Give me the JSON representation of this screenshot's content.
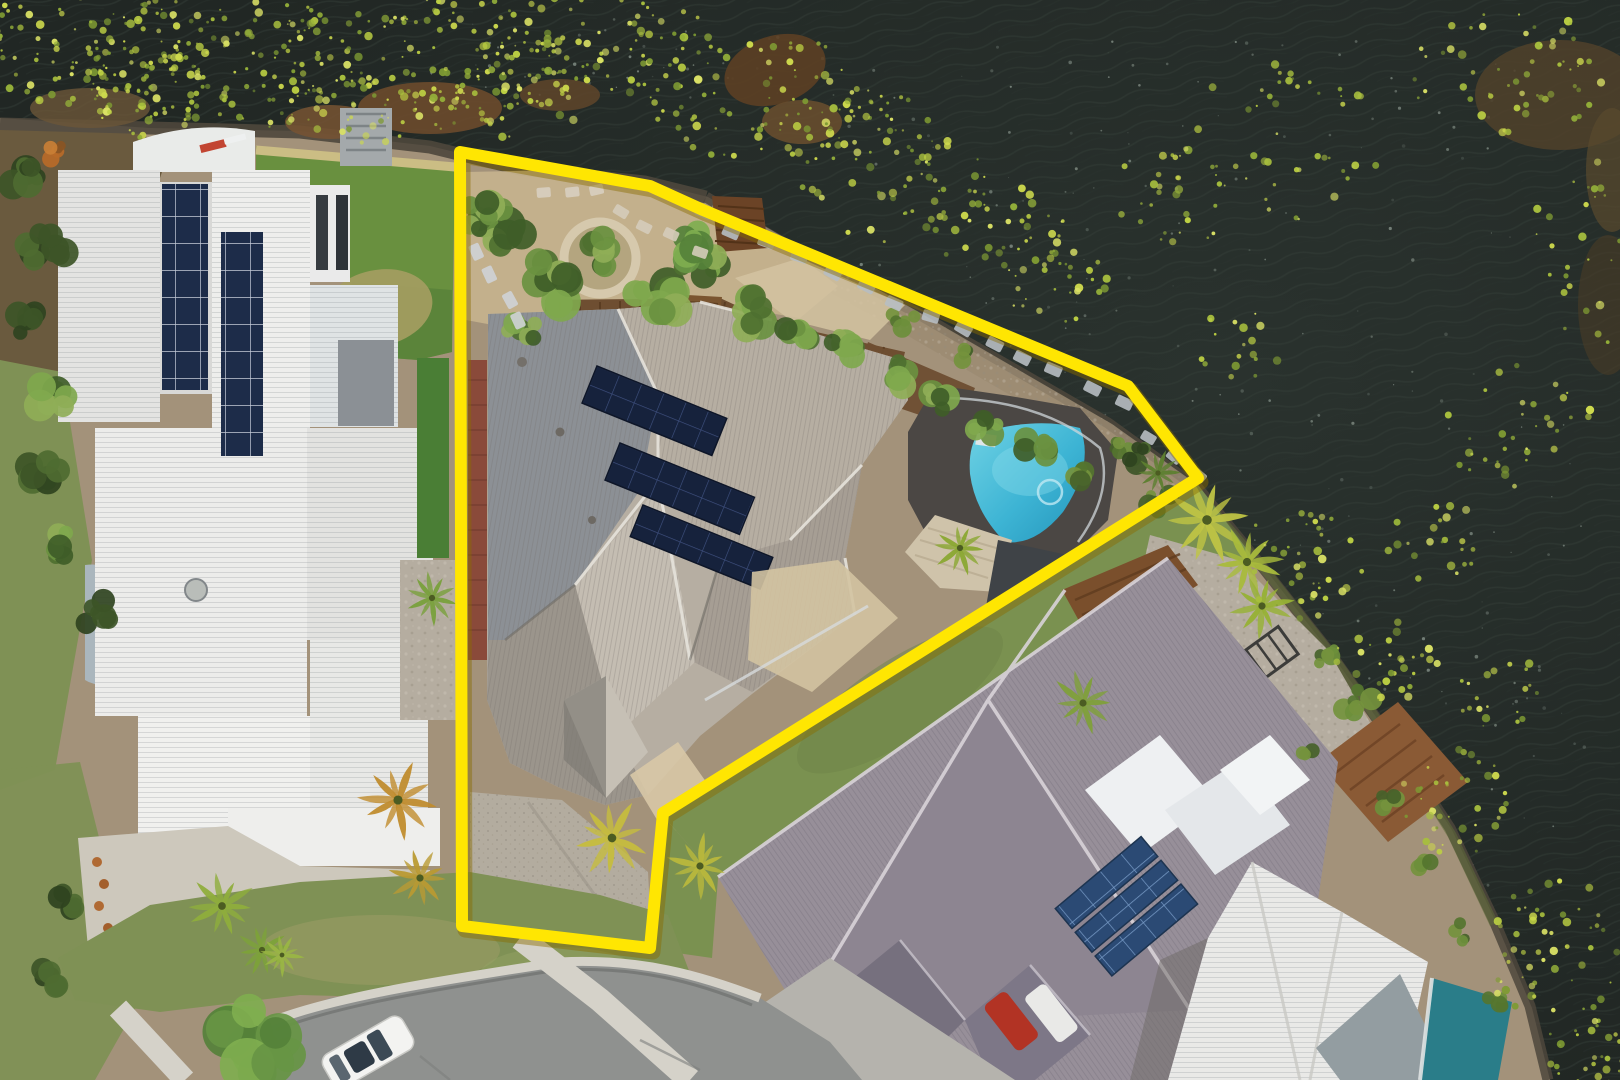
{
  "meta": {
    "type": "aerial-drone-photograph",
    "description": "Top-down aerial photo of a waterfront home outlined with a bright yellow property boundary. Dark lake water with lily pads fills the top and right. A large white-roofed neighbour house with solar panels sits left, the outlined grey-roofed house with solar panels, gardens and a curved blue pool sits centre, and a purple-grey roofed neighbour with its own pool sits lower right. A cul-de-sac road with a white car crosses the bottom left.",
    "visible_text": []
  },
  "boundary": {
    "label": "property-boundary-outline",
    "points": "460,152 650,186 703,210 1128,386 1198,478 663,813 650,948 462,926",
    "color": "#ffe602"
  },
  "palette": {
    "water": "#212724",
    "ripple": "#39433d",
    "landBase": "#a3927a",
    "rockEdge": "#4e473c",
    "gravelPath": "#c5b28d",
    "pebble": "#b5ada0",
    "lawn": "#7f9155",
    "lawnR": "#7a9150",
    "roofWhite": "#e9e9e7",
    "roofDark": "#8c9095",
    "roofLight": "#b6aea2",
    "roofMid": "#a69e94",
    "roofPale": "#c4bdb2",
    "roofR": "#978f99",
    "brick": "#8a4a3a",
    "deck": "#6e4e31",
    "deckLight": "#cfc3aa",
    "paving": "#4b4744",
    "greenPool": "#69903f",
    "turf": "#4a7e35",
    "road": "#8f918f",
    "concrete": "#d5d2c9",
    "drive": "#b3ac9f",
    "yellow": "#ffe602",
    "poolTeal": "#2a7d89"
  },
  "landmarks": {
    "water": "lake water",
    "lilypads": "yellow-green lily pad mats",
    "subject_house": "outlined house with grey roof and solar panels",
    "subject_pool": "curved blue swimming pool",
    "left_house": "white-roofed neighbour with rooftop solar",
    "left_green_pool": "green lap pool",
    "right_house": "purple-grey roofed neighbour",
    "right_pool": "turquoise rectangular pool",
    "jetty": "timber jetty",
    "road": "cul-de-sac street",
    "car": "white parked car"
  },
  "scatter": {
    "lilypad_colors": [
      "#cdd94d",
      "#bccf43",
      "#a8bf3e",
      "#93ae39",
      "#d9e065",
      "#7e9a33"
    ],
    "lilypads": [
      [
        60,
        45,
        130,
        60,
        100
      ],
      [
        225,
        60,
        140,
        70,
        130
      ],
      [
        420,
        60,
        150,
        70,
        140
      ],
      [
        600,
        45,
        120,
        55,
        80
      ],
      [
        755,
        95,
        110,
        65,
        80
      ],
      [
        895,
        185,
        95,
        60,
        60
      ],
      [
        1000,
        230,
        65,
        45,
        35
      ],
      [
        880,
        120,
        55,
        35,
        25
      ],
      [
        1185,
        195,
        75,
        50,
        30
      ],
      [
        1290,
        135,
        95,
        85,
        45
      ],
      [
        1505,
        70,
        100,
        65,
        55
      ],
      [
        1595,
        230,
        60,
        120,
        40
      ],
      [
        1520,
        430,
        75,
        65,
        35
      ],
      [
        1060,
        285,
        55,
        40,
        28
      ],
      [
        1300,
        565,
        65,
        55,
        40
      ],
      [
        1385,
        665,
        55,
        45,
        30
      ],
      [
        1455,
        805,
        60,
        60,
        40
      ],
      [
        1555,
        955,
        65,
        85,
        55
      ],
      [
        1595,
        1060,
        55,
        40,
        35
      ],
      [
        160,
        95,
        70,
        45,
        45
      ],
      [
        340,
        110,
        80,
        40,
        40
      ],
      [
        520,
        100,
        70,
        40,
        35
      ],
      [
        1240,
        345,
        45,
        35,
        18
      ],
      [
        1435,
        545,
        50,
        45,
        22
      ],
      [
        1500,
        690,
        45,
        40,
        20
      ]
    ],
    "sparkle_color": "#a7b5aa",
    "sparkles": [
      [
        820,
        40,
        700,
        380,
        120
      ],
      [
        1150,
        380,
        440,
        520,
        110
      ],
      [
        430,
        15,
        350,
        85,
        40
      ],
      [
        980,
        430,
        180,
        120,
        25
      ]
    ],
    "shrub_palettes": [
      [
        "#4e7030",
        "#6a9140",
        "#7fa84d",
        "#3f5d28",
        "#8fae57"
      ],
      [
        "#55752f",
        "#6c8f3b",
        "#46622a",
        "#74923d"
      ],
      [
        "#3d5527",
        "#4e6b31",
        "#2f431f"
      ],
      [
        "#b86a28",
        "#c97f35",
        "#8a5524"
      ],
      [
        "#679544",
        "#7fae4f",
        "#55813a"
      ]
    ],
    "shrubs": [
      [
        500,
        225,
        34,
        9,
        0
      ],
      [
        545,
        285,
        38,
        10,
        0
      ],
      [
        600,
        255,
        30,
        8,
        0
      ],
      [
        655,
        300,
        32,
        9,
        0
      ],
      [
        700,
        262,
        26,
        7,
        0
      ],
      [
        745,
        315,
        30,
        8,
        0
      ],
      [
        795,
        332,
        26,
        7,
        0
      ],
      [
        845,
        352,
        26,
        7,
        0
      ],
      [
        890,
        375,
        24,
        6,
        0
      ],
      [
        935,
        400,
        24,
        6,
        0
      ],
      [
        985,
        425,
        22,
        6,
        0
      ],
      [
        1035,
        450,
        22,
        6,
        0
      ],
      [
        1082,
        470,
        20,
        6,
        1
      ],
      [
        1120,
        452,
        18,
        5,
        1
      ],
      [
        690,
        248,
        26,
        8,
        4
      ],
      [
        30,
        180,
        26,
        7,
        2
      ],
      [
        45,
        250,
        28,
        8,
        2
      ],
      [
        30,
        320,
        24,
        7,
        2
      ],
      [
        55,
        400,
        28,
        8,
        0
      ],
      [
        40,
        470,
        26,
        7,
        2
      ],
      [
        60,
        545,
        24,
        7,
        0
      ],
      [
        95,
        612,
        22,
        6,
        2
      ],
      [
        55,
        152,
        15,
        5,
        3
      ],
      [
        1135,
        455,
        20,
        6,
        2
      ],
      [
        1158,
        500,
        18,
        5,
        1
      ],
      [
        1325,
        655,
        17,
        5,
        1
      ],
      [
        1357,
        702,
        21,
        6,
        1
      ],
      [
        1302,
        748,
        15,
        4,
        1
      ],
      [
        1387,
        797,
        18,
        5,
        1
      ],
      [
        1422,
        862,
        15,
        4,
        1
      ],
      [
        1462,
        932,
        14,
        4,
        1
      ],
      [
        1492,
        1002,
        15,
        5,
        1
      ],
      [
        255,
        1040,
        52,
        13,
        4
      ],
      [
        60,
        905,
        22,
        6,
        2
      ],
      [
        52,
        975,
        20,
        6,
        2
      ],
      [
        480,
        215,
        22,
        6,
        0
      ],
      [
        522,
        330,
        20,
        6,
        0
      ],
      [
        905,
        318,
        18,
        5,
        1
      ],
      [
        965,
        352,
        16,
        5,
        1
      ]
    ],
    "palms": [
      {
        "x": 432,
        "y": 598,
        "r": 26,
        "rot": 10,
        "c": "#79a03c"
      },
      {
        "x": 1207,
        "y": 520,
        "r": 40,
        "rot": -10,
        "c": "#bfc444"
      },
      {
        "x": 1247,
        "y": 562,
        "r": 34,
        "rot": 25,
        "c": "#a9bb3c"
      },
      {
        "x": 1262,
        "y": 606,
        "r": 30,
        "rot": 60,
        "c": "#97b135"
      },
      {
        "x": 1083,
        "y": 703,
        "r": 30,
        "rot": 0,
        "c": "#7fa03a"
      },
      {
        "x": 612,
        "y": 838,
        "r": 36,
        "rot": 15,
        "c": "#c6bd3e"
      },
      {
        "x": 700,
        "y": 866,
        "r": 30,
        "rot": -20,
        "c": "#b9b83c"
      },
      {
        "x": 398,
        "y": 800,
        "r": 38,
        "rot": 0,
        "c": "#c08c2e"
      },
      {
        "x": 420,
        "y": 878,
        "r": 30,
        "rot": 40,
        "c": "#b99a33"
      },
      {
        "x": 222,
        "y": 906,
        "r": 32,
        "rot": 0,
        "c": "#8fae3c"
      },
      {
        "x": 262,
        "y": 950,
        "r": 26,
        "rot": 30,
        "c": "#7da239"
      },
      {
        "x": 960,
        "y": 548,
        "r": 26,
        "rot": 0,
        "c": "#8aa832"
      },
      {
        "x": 1158,
        "y": 473,
        "r": 22,
        "rot": 0,
        "c": "#5d7f2f"
      },
      {
        "x": 282,
        "y": 955,
        "r": 20,
        "rot": 80,
        "c": "#9ab544"
      }
    ],
    "stones": [
      [
        702,
        216,
        1122,
        402,
        14,
        17,
        11,
        "#b7bec2"
      ],
      [
        1150,
        440,
        1196,
        472,
        3,
        15,
        10,
        "#b7bec2"
      ],
      [
        478,
        250,
        520,
        320,
        4,
        16,
        11,
        "#cfd3d6"
      ],
      [
        620,
        210,
        700,
        250,
        4,
        15,
        10,
        "#d5ccba"
      ],
      [
        540,
        195,
        600,
        190,
        3,
        14,
        10,
        "#d8cfc0"
      ]
    ]
  }
}
